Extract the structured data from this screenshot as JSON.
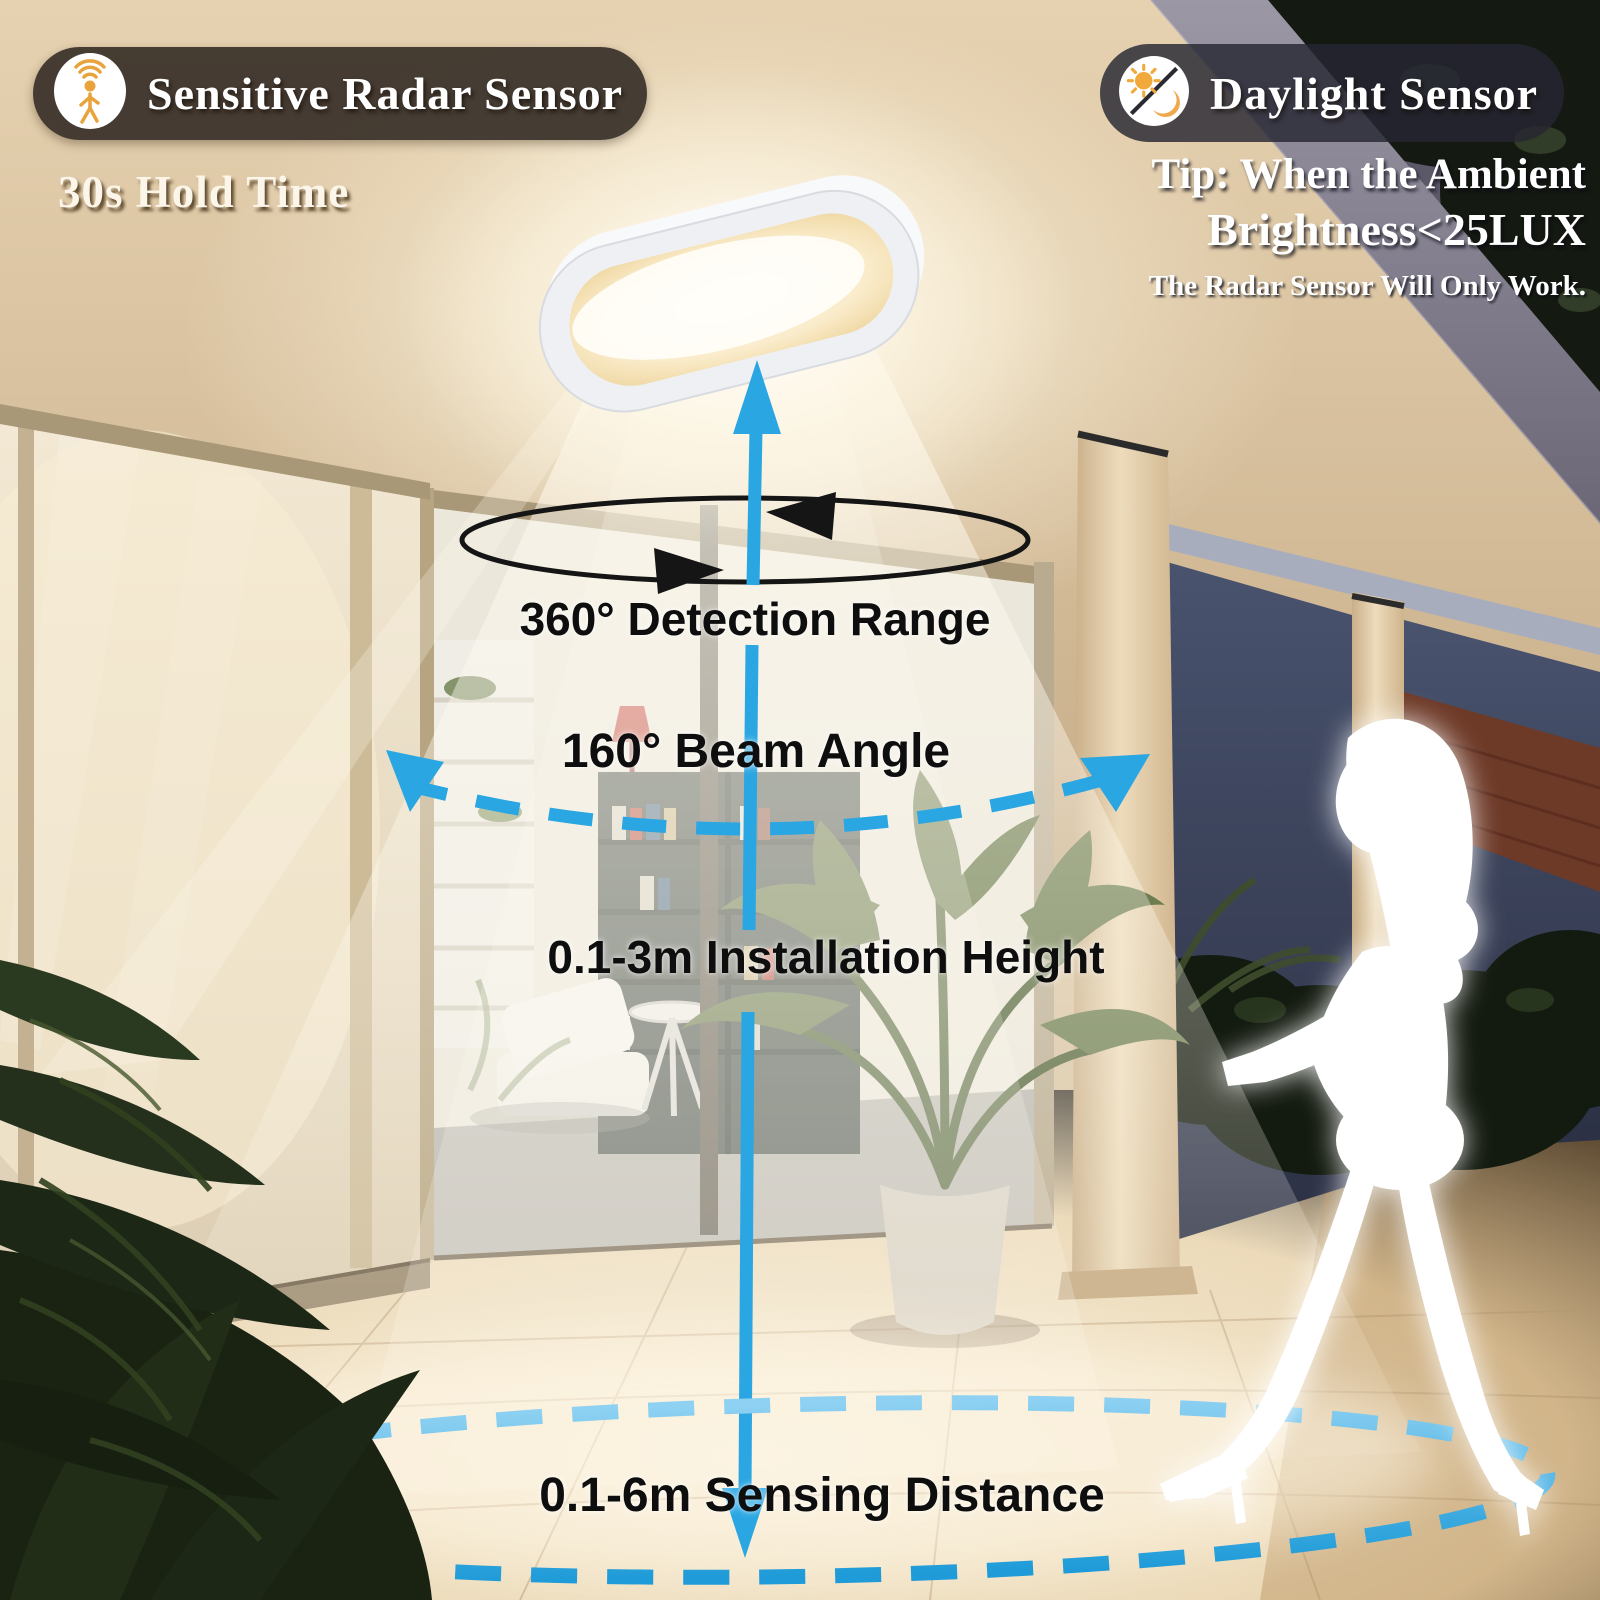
{
  "badges": {
    "radar_label": "Sensitive Radar Sensor",
    "radar_icon": "walking-person-radar-icon",
    "daylight_label": "Daylight Sensor",
    "daylight_icon": "sun-moon-icon"
  },
  "tips": {
    "hold_time": "30s Hold Time",
    "tip_line1": "Tip: When the Ambient",
    "tip_line2": "Brightness<25LUX",
    "tip_line3": "The Radar Sensor Will Only Work."
  },
  "annotations": {
    "detection_range": "360° Detection Range",
    "beam_angle": "160° Beam Angle",
    "installation_height": "0.1-3m Installation Height",
    "sensing_distance": "0.1-6m Sensing Distance"
  },
  "colors": {
    "accent_blue": "#2AA6E2",
    "accent_blue_light": "#8ED1F2",
    "annotation_black": "#0E0E0E",
    "badge_left_bg": "#3A322B",
    "badge_right_bg": "#262632",
    "icon_orange": "#E8A33D",
    "light_warm": "#FFF6E0",
    "rotation_arrow_black": "#151515",
    "silhouette_white": "#FFFFFF"
  }
}
